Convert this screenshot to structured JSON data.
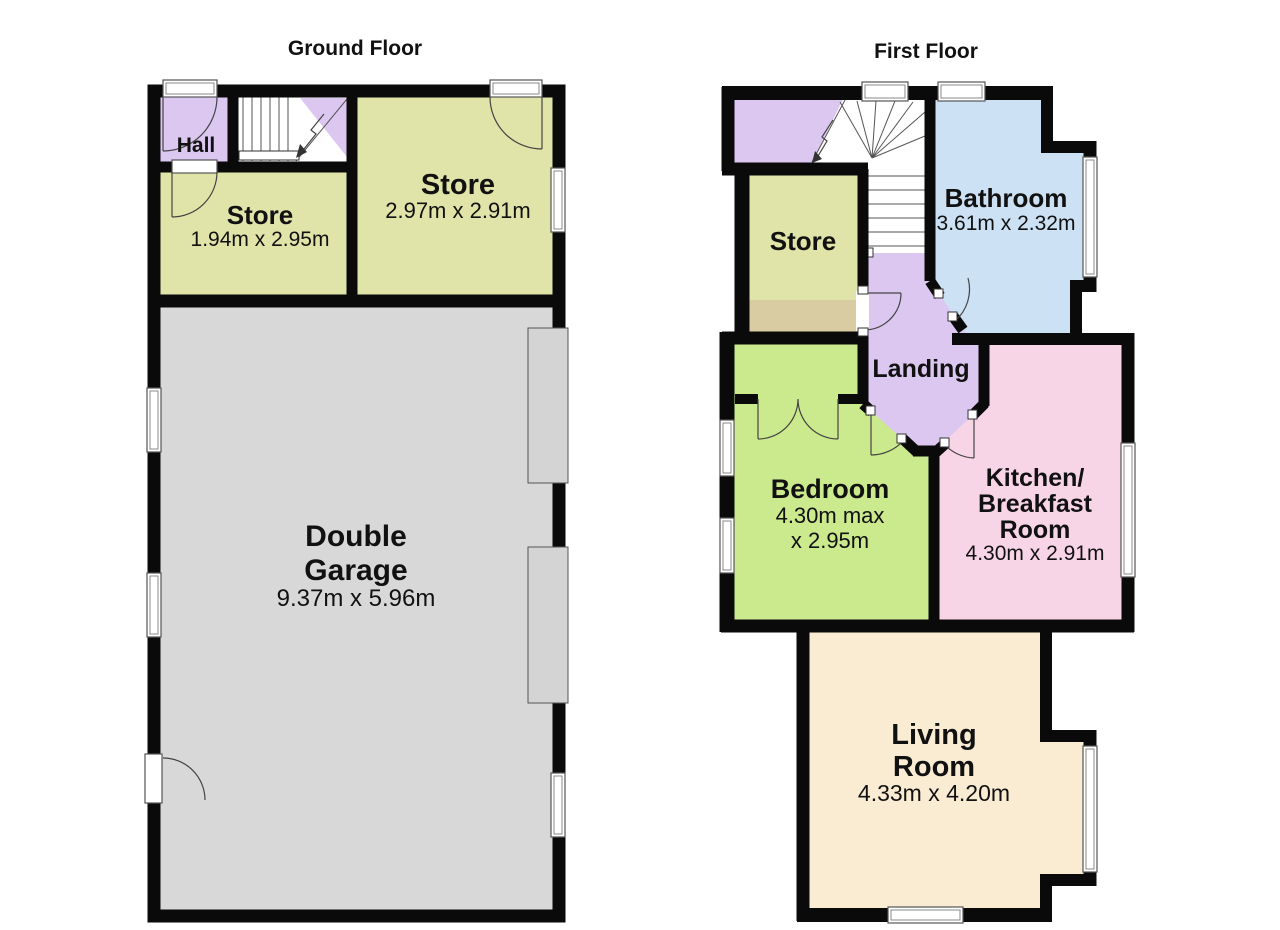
{
  "ground_floor": {
    "title": "Ground Floor",
    "rooms": {
      "hall": {
        "label": "Hall",
        "color": "#dcc7f0"
      },
      "store_left": {
        "label": "Store",
        "dims": "1.94m x 2.95m",
        "color": "#e0e4a8"
      },
      "store_right": {
        "label": "Store",
        "dims": "2.97m x 2.91m",
        "color": "#e0e4a8"
      },
      "garage": {
        "label_lines": [
          "Double",
          "Garage"
        ],
        "dims": "9.37m x 5.96m",
        "color": "#d8d8d8"
      }
    }
  },
  "first_floor": {
    "title": "First Floor",
    "rooms": {
      "store": {
        "label": "Store",
        "color": "#e0e4a8"
      },
      "bathroom": {
        "label": "Bathroom",
        "dims": "3.61m x 2.32m",
        "color": "#cde1f4"
      },
      "landing": {
        "label": "Landing",
        "color": "#dcc7f0"
      },
      "bedroom": {
        "label": "Bedroom",
        "dims_lines": [
          "4.30m max",
          "x 2.95m"
        ],
        "color": "#cbe98d"
      },
      "kitchen": {
        "label_lines": [
          "Kitchen/",
          "Breakfast",
          "Room"
        ],
        "dims": "4.30m x 2.91m",
        "color": "#f8d5e6"
      },
      "living_room": {
        "label_lines": [
          "Living",
          "Room"
        ],
        "dims": "4.33m x 4.20m",
        "color": "#faecd2"
      }
    }
  },
  "palette": {
    "wall": "#0a0a0a",
    "stairwell": "#dcc7f0",
    "eaves_store": "#d9cca2",
    "garage_door": "#d4d4d4",
    "text": "#111111",
    "background": "#ffffff"
  }
}
